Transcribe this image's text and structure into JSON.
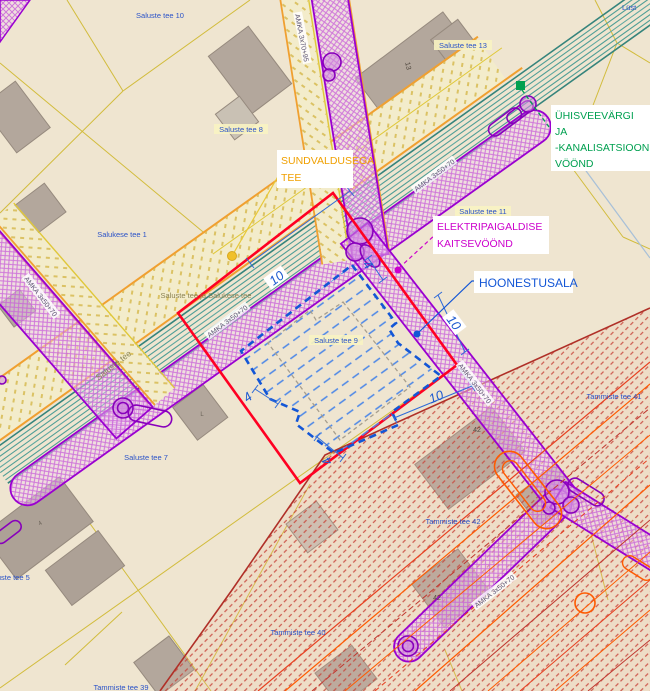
{
  "canvas": {
    "width": 650,
    "height": 691
  },
  "callouts": {
    "sundvaldusega_tee": {
      "line1": "SUNDVALDUSEGA",
      "line2": "TEE"
    },
    "uhisveevargi": {
      "line1": "ÜHISVEEVÄRGI",
      "line2": "JA",
      "line3": "-KANALISATSIOONI",
      "line4": "VÖÖND"
    },
    "elektripaigaldise": {
      "line1": "ELEKTRIPAIGALDISE",
      "line2": "KAITSEVÖÖND"
    },
    "hoonestusala": {
      "label": "HOONESTUSALA"
    }
  },
  "parcels": {
    "saluste_tee_10": "Saluste tee 10",
    "saluste_tee_13": "Saluste tee 13",
    "saluste_tee_8": "Saluste tee 8",
    "salukese_tee_1": "Salukese tee 1",
    "saluste_tee_11": "Saluste tee 11",
    "saluste_tee_9": "Saluste tee 9",
    "saluste_salukese": "Saluste tee ja Salukese tee",
    "saluste_tee_7": "Saluste tee 7",
    "saluste_tee_5": "Saluste tee 5",
    "tammiste_tee_41": "Tammiste tee 41",
    "tammiste_tee_42": "Tammiste tee 42",
    "tammiste_tee_40": "Tammiste tee 40",
    "tammiste_tee_39": "Tammiste tee 39",
    "lust": "Lüst"
  },
  "roads": {
    "saluste_tee": "Saluste tee",
    "amka_3x70_95": "AMKA 3x70+95",
    "amka_3x50_70": "AMKA 3x50+70"
  },
  "dimensions": {
    "ten": "10",
    "four": "4"
  },
  "building_numbers": {
    "n13": "13",
    "n42": "42",
    "nL": "L",
    "n4": "4"
  },
  "colors": {
    "background": "#EFE5D0",
    "red_boundary": "#FF0022",
    "blue_annotation": "#1356D6",
    "magenta_zone": "#CC00CC",
    "green_zone": "#00A050",
    "orange_callout": "#F0A000",
    "purple_band": "#9A00D0",
    "teal_utility": "#4F9E96",
    "red_hatch": "#C8453C",
    "cadastral_yellow": "#D2BC3C"
  }
}
